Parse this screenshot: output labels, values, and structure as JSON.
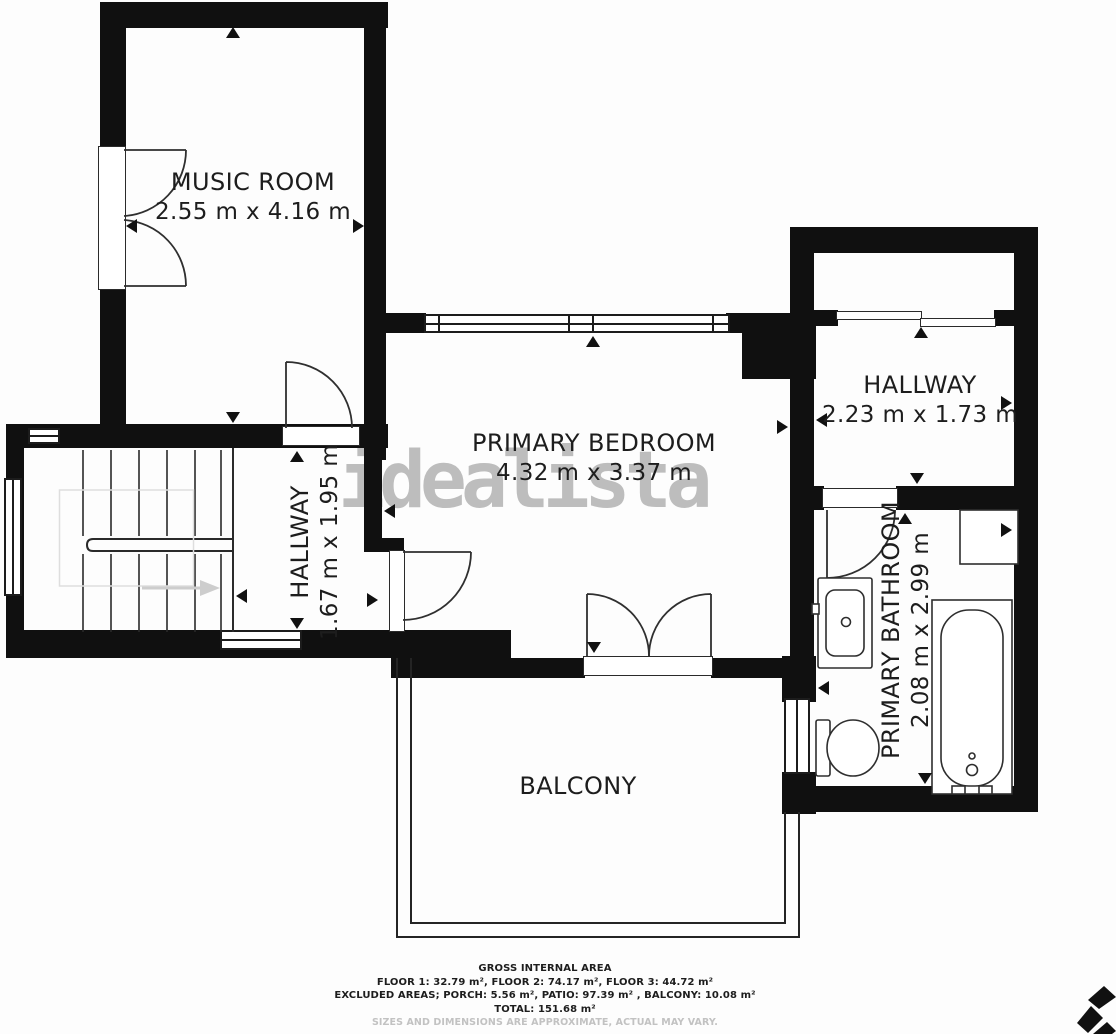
{
  "watermark": {
    "text": "idealista"
  },
  "rooms": {
    "music_room": {
      "name": "MUSIC ROOM",
      "dims": "2.55 m x 4.16 m"
    },
    "primary_bedroom": {
      "name": "PRIMARY BEDROOM",
      "dims": "4.32 m x 3.37 m"
    },
    "hallway_left": {
      "name": "HALLWAY",
      "dims": "1.67 m x 1.95 m"
    },
    "hallway_right": {
      "name": "HALLWAY",
      "dims": "2.23 m x 1.73 m"
    },
    "primary_bathroom": {
      "name": "PRIMARY BATHROOM",
      "dims": "2.08 m x 2.99 m"
    },
    "balcony": {
      "name": "BALCONY"
    }
  },
  "footer": {
    "title": "GROSS INTERNAL AREA",
    "floors": "FLOOR 1: 32.79 m², FLOOR 2: 74.17 m², FLOOR 3: 44.72 m²",
    "excluded": "EXCLUDED AREAS; PORCH: 5.56 m², PATIO: 97.39 m² , BALCONY: 10.08 m²",
    "total": "TOTAL: 151.68 m²",
    "disclaimer": "SIZES AND DIMENSIONS ARE APPROXIMATE, ACTUAL MAY VARY."
  },
  "colors": {
    "wall": "#101010",
    "line": "#2f2f2f",
    "watermark": "#b2b2b2"
  }
}
